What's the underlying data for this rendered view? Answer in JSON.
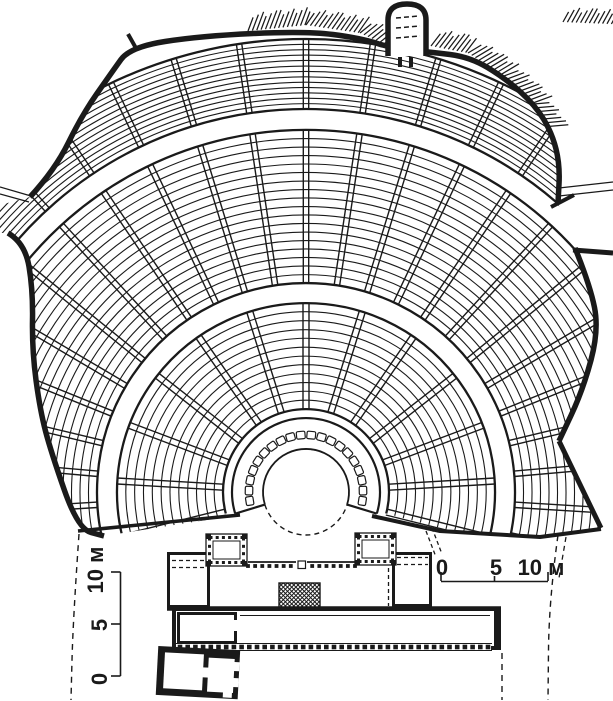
{
  "figure": {
    "kind": "architectural plan drawing",
    "subject": "ancient Greek theatre plan (cavea, orchestra, skene stage building)",
    "background": "#ffffff",
    "ink": "#1a1a1a"
  },
  "scale_bars": {
    "left": {
      "labels": [
        "0",
        "5",
        "10 м"
      ]
    },
    "right": {
      "labels": [
        "0",
        "5",
        "10 м"
      ]
    }
  },
  "diagram": {
    "canvas": {
      "w": 613,
      "h": 701
    },
    "ink": "#1a1a1a",
    "center": {
      "x": 306,
      "y": 492
    },
    "orchestra_radius": 43,
    "ring": {
      "inner": 43,
      "outer": 74,
      "a0": 197,
      "a1": -17,
      "slab_r": 57,
      "slab_count": 20,
      "slab_a0": 189,
      "slab_a1": -9,
      "slab_w": 8.6,
      "slab_h": 7.5
    },
    "tiers": [
      {
        "name": "lower",
        "r0": 83,
        "r1": 189,
        "rows": 13,
        "a0": 195,
        "a1": -15,
        "stairs": {
          "a0": 194,
          "a1": -14,
          "count": 13,
          "half": 3.0
        }
      },
      {
        "name": "middle",
        "r0": 209,
        "r1": 362,
        "rows": 19,
        "a0": 202,
        "a1": -22,
        "stairs": {
          "a0": 192,
          "a1": -12,
          "count": 25,
          "half": 2.7
        }
      },
      {
        "name": "upper",
        "r0": 383,
        "r1": 453,
        "rows": 14,
        "a0": 202,
        "a1": -22,
        "stairs": {
          "a0": 192,
          "a1": -12,
          "count": 25,
          "half": 2.7
        }
      }
    ],
    "clip": [
      [
        30,
        197
      ],
      [
        55,
        170
      ],
      [
        82,
        115
      ],
      [
        112,
        72
      ],
      [
        130,
        47
      ],
      [
        200,
        36
      ],
      [
        306,
        31
      ],
      [
        360,
        38
      ],
      [
        395,
        49
      ],
      [
        430,
        52
      ],
      [
        470,
        57
      ],
      [
        505,
        77
      ],
      [
        535,
        105
      ],
      [
        552,
        133
      ],
      [
        560,
        165
      ],
      [
        558,
        203
      ],
      [
        575,
        248
      ],
      [
        590,
        285
      ],
      [
        599,
        330
      ],
      [
        583,
        390
      ],
      [
        559,
        441
      ],
      [
        601,
        529
      ],
      [
        540,
        537
      ],
      [
        440,
        531
      ],
      [
        367,
        516
      ],
      [
        306,
        543
      ],
      [
        245,
        514
      ],
      [
        104,
        536
      ],
      [
        78,
        529
      ],
      [
        51,
        452
      ],
      [
        40,
        410
      ],
      [
        32,
        350
      ],
      [
        33,
        290
      ],
      [
        25,
        243
      ],
      [
        8,
        233
      ],
      [
        0,
        233
      ],
      [
        0,
        205
      ]
    ],
    "walls": {
      "upper": [
        [
          30,
          197
        ],
        [
          55,
          170
        ],
        [
          82,
          115
        ],
        [
          112,
          72
        ],
        [
          130,
          47
        ],
        [
          200,
          36
        ],
        [
          306,
          31
        ],
        [
          360,
          38
        ],
        [
          395,
          49
        ],
        [
          430,
          52
        ],
        [
          470,
          57
        ],
        [
          505,
          78
        ],
        [
          535,
          105
        ],
        [
          552,
          133
        ],
        [
          560,
          165
        ],
        [
          558,
          203
        ]
      ],
      "lower_left": [
        [
          8,
          233
        ],
        [
          25,
          243
        ],
        [
          33,
          290
        ],
        [
          32,
          350
        ],
        [
          40,
          410
        ],
        [
          51,
          452
        ],
        [
          78,
          529
        ],
        [
          104,
          536
        ]
      ],
      "lower_right": [
        [
          575,
          248
        ],
        [
          590,
          285
        ],
        [
          599,
          330
        ],
        [
          583,
          390
        ],
        [
          559,
          441
        ]
      ],
      "corner_right": [
        [
          559,
          441
        ],
        [
          601,
          528
        ]
      ],
      "cut_left": [
        [
          78,
          531
        ],
        [
          240,
          515
        ]
      ],
      "cut_right": [
        [
          372,
          516
        ],
        [
          440,
          531
        ],
        [
          540,
          537
        ],
        [
          601,
          529
        ]
      ],
      "spur": [
        [
          573,
          250
        ],
        [
          613,
          253
        ]
      ],
      "stub": [
        [
          128,
          34
        ],
        [
          137,
          50
        ]
      ],
      "cap": [
        [
          551,
          207
        ],
        [
          574,
          195
        ]
      ],
      "passages": [
        [
          [
            0,
            187
          ],
          [
            31,
            196
          ]
        ],
        [
          [
            0,
            194
          ],
          [
            29,
            202
          ]
        ],
        [
          [
            559,
            188
          ],
          [
            613,
            182
          ]
        ],
        [
          [
            559,
            196
          ],
          [
            613,
            190
          ]
        ]
      ]
    },
    "hatch": {
      "spacing": 4.4,
      "bands": [
        {
          "pts": [
            [
              248,
              31
            ],
            [
              306,
              25
            ],
            [
              360,
              33
            ],
            [
              384,
              44
            ]
          ],
          "len": 17
        },
        {
          "pts": [
            [
              431,
              46
            ],
            [
              468,
              53
            ],
            [
              504,
              76
            ],
            [
              534,
              104
            ],
            [
              550,
              130
            ]
          ],
          "len": 18
        },
        {
          "pts": [
            [
              563,
              22
            ],
            [
              612,
              24
            ]
          ],
          "len": 14
        }
      ]
    },
    "gate": {
      "d": "M388 56 L388 20 Q388 4 407 4 Q426 4 426 20 L426 56",
      "dashes": [
        [
          [
            396,
            18
          ],
          [
            419,
            16
          ]
        ],
        [
          [
            396,
            28
          ],
          [
            420,
            26
          ]
        ],
        [
          [
            396,
            38
          ],
          [
            420,
            36
          ]
        ]
      ],
      "jambs": [
        [
          398,
          57,
          4,
          10
        ],
        [
          409,
          57,
          4,
          10
        ]
      ]
    },
    "stage": {
      "prims": [
        {
          "t": "rect",
          "x": 167,
          "y": 552,
          "w": 265,
          "h": 56,
          "f": "#fff"
        },
        {
          "t": "rect",
          "x": 168.5,
          "y": 553.5,
          "w": 40,
          "h": 53,
          "s": 3
        },
        {
          "t": "rect",
          "x": 393.5,
          "y": 553.5,
          "w": 37,
          "h": 52,
          "s": 3
        },
        {
          "t": "line",
          "pts": [
            [
              172,
              560.5
            ],
            [
              205,
              560.5
            ]
          ],
          "w": 1.2,
          "dash": "4 3"
        },
        {
          "t": "line",
          "pts": [
            [
              172,
              567.5
            ],
            [
              205,
              567.5
            ]
          ],
          "w": 1.2,
          "dash": "4 3"
        },
        {
          "t": "line",
          "pts": [
            [
              397,
              557.5
            ],
            [
              428,
              557.5
            ]
          ],
          "w": 1.2,
          "dash": "4 3"
        },
        {
          "t": "line",
          "pts": [
            [
              397,
              564.5
            ],
            [
              428,
              564.5
            ]
          ],
          "w": 1.2,
          "dash": "4 3"
        },
        {
          "t": "line",
          "pts": [
            [
              248,
              562
            ],
            [
              355,
              562
            ]
          ],
          "w": 1.7
        },
        {
          "t": "dots",
          "x0": 248,
          "y0": 566,
          "x1": 355,
          "y1": 566,
          "size": 3.8,
          "gap": 6.8
        },
        {
          "t": "rect",
          "x": 296,
          "y": 559,
          "w": 11,
          "h": 10,
          "f": "#fff"
        },
        {
          "t": "rect",
          "x": 298,
          "y": 561,
          "w": 7.5,
          "h": 7.5,
          "s": 1.2
        },
        {
          "t": "tower",
          "x": 206,
          "y": 534,
          "w": 41,
          "h": 32
        },
        {
          "t": "tower",
          "x": 355,
          "y": 533,
          "w": 41,
          "h": 32
        },
        {
          "t": "line",
          "pts": [
            [
              208.5,
              568
            ],
            [
              208.5,
              606
            ]
          ],
          "w": 1.3,
          "dash": "4 3"
        },
        {
          "t": "line",
          "pts": [
            [
              388.5,
              568
            ],
            [
              388.5,
              606
            ]
          ],
          "w": 1.3,
          "dash": "4 3"
        },
        {
          "t": "xhatch",
          "x": 279,
          "y": 583,
          "w": 41,
          "h": 25,
          "step": 4.2
        },
        {
          "t": "line",
          "pts": [
            [
              167,
              608.5
            ],
            [
              501,
              608.5
            ]
          ],
          "w": 4.5
        },
        {
          "t": "rect",
          "x": 174,
          "y": 609,
          "w": 325,
          "h": 39,
          "s": 4,
          "f": "#fff"
        },
        {
          "t": "line",
          "pts": [
            [
              240,
              615.5
            ],
            [
              490,
              615.5
            ]
          ],
          "w": 1
        },
        {
          "t": "rect",
          "x": 178.5,
          "y": 613.5,
          "w": 57,
          "h": 29,
          "s": 3,
          "f": "#fff"
        },
        {
          "t": "rect",
          "x": 234,
          "y": 620,
          "w": 5,
          "h": 11,
          "f": "#fff"
        },
        {
          "t": "line",
          "pts": [
            [
              496.5,
              609
            ],
            [
              496.5,
              648
            ]
          ],
          "w": 5
        },
        {
          "t": "rect",
          "x": 176,
          "y": 643,
          "w": 315,
          "h": 8,
          "f": "#fff"
        },
        {
          "t": "line",
          "pts": [
            [
              176,
              643.5
            ],
            [
              492,
              643.5
            ]
          ],
          "w": 1.1
        },
        {
          "t": "line",
          "pts": [
            [
              176,
              650.5
            ],
            [
              492,
              650.5
            ]
          ],
          "w": 1.1
        },
        {
          "t": "dots",
          "x0": 180,
          "y0": 647,
          "x1": 488,
          "y1": 647,
          "size": 4.6,
          "gap": 7.6
        }
      ]
    },
    "annex": {
      "rotate": [
        3,
        196,
        672
      ],
      "prims": [
        {
          "t": "rect",
          "x": 157,
          "y": 648,
          "w": 82,
          "h": 49,
          "f": "#1a1a1a"
        },
        {
          "t": "rect",
          "x": 164,
          "y": 654,
          "w": 39,
          "h": 36,
          "f": "#fff"
        },
        {
          "t": "rect",
          "x": 208,
          "y": 657,
          "w": 26,
          "h": 34,
          "f": "#fff"
        },
        {
          "t": "rect",
          "x": 202,
          "y": 667,
          "w": 7,
          "h": 10,
          "f": "#fff"
        },
        {
          "t": "rect",
          "x": 231,
          "y": 660,
          "w": 8,
          "h": 9,
          "f": "#fff"
        },
        {
          "t": "rect",
          "x": 231,
          "y": 676,
          "w": 8,
          "h": 9,
          "f": "#fff"
        },
        {
          "t": "rect",
          "x": 224,
          "y": 689,
          "w": 9,
          "h": 7,
          "f": "#fff"
        }
      ]
    },
    "dashes": [
      {
        "pts": [
          [
            79,
            534
          ],
          [
            73,
            620
          ],
          [
            71,
            700
          ]
        ],
        "dash": "6 5",
        "w": 1.4,
        "smooth": true
      },
      {
        "pts": [
          [
            502,
            653
          ],
          [
            502,
            700
          ]
        ],
        "dash": "6 5",
        "w": 1.4
      },
      {
        "pts": [
          [
            558,
            535
          ],
          [
            549,
            600
          ],
          [
            548,
            700
          ]
        ],
        "dash": "6 5",
        "w": 1.4,
        "smooth": true
      },
      {
        "pts": [
          [
            566,
            537
          ],
          [
            559,
            578
          ]
        ],
        "dash": "5 4",
        "w": 1.3
      },
      {
        "pts": [
          [
            426,
            531
          ],
          [
            436,
            557
          ]
        ],
        "dash": "4 3",
        "w": 1.3
      },
      {
        "pts": [
          [
            432,
            528
          ],
          [
            442,
            554
          ]
        ],
        "dash": "4 3",
        "w": 1.3
      }
    ],
    "scalebar_left": {
      "line": [
        [
          120.5,
          572
        ],
        [
          120.5,
          676
        ]
      ],
      "ticks": [
        [
          [
            120.5,
            572
          ],
          [
            111,
            572
          ]
        ],
        [
          [
            120.5,
            624
          ],
          [
            111,
            624
          ]
        ],
        [
          [
            120.5,
            676
          ],
          [
            111,
            676
          ]
        ]
      ],
      "label_pos": [
        {
          "x": 107,
          "y": 679,
          "rot": -90
        },
        {
          "x": 107,
          "y": 625,
          "rot": -90
        },
        {
          "x": 103,
          "y": 570,
          "rot": -90
        }
      ]
    },
    "scalebar_right": {
      "line": [
        [
          441,
          581.5
        ],
        [
          548,
          581.5
        ]
      ],
      "ticks": [
        [
          [
            441,
            581
          ],
          [
            441,
            572
          ]
        ],
        [
          [
            548,
            581
          ],
          [
            548,
            572
          ]
        ],
        [
          [
            494.5,
            581
          ],
          [
            494.5,
            576
          ]
        ]
      ],
      "label_pos": [
        {
          "x": 442,
          "y": 575,
          "rot": 0
        },
        {
          "x": 496,
          "y": 575,
          "rot": 0
        },
        {
          "x": 541,
          "y": 575,
          "rot": 0
        }
      ]
    }
  }
}
